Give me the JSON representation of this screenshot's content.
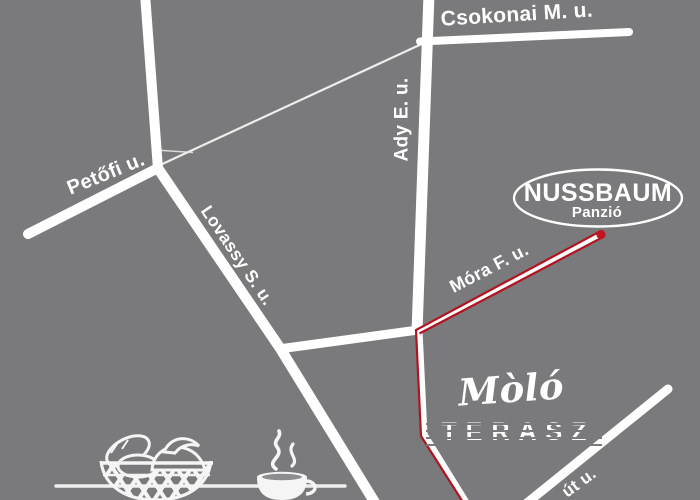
{
  "colors": {
    "background": "#7a797b",
    "road": "#ffffff",
    "route_red": "#b11420",
    "label_text": "#ffffff"
  },
  "streets": {
    "csokonai": "Csokonai M. u.",
    "ady": "Ady E. u.",
    "petofi": "Petőfi u.",
    "lovassy": "Lovassy S. u.",
    "mora": "Móra F. u.",
    "bottom_right_fragment": "út u."
  },
  "destination": {
    "name": "NUSSBAUM",
    "subtitle": "Panzió",
    "marker": "red-dot-marker"
  },
  "venue": {
    "name_script": "Mòló",
    "name_caps": "TERASZ"
  },
  "icons": {
    "basket": "bread-basket-icon",
    "cup": "coffee-cup-icon"
  }
}
